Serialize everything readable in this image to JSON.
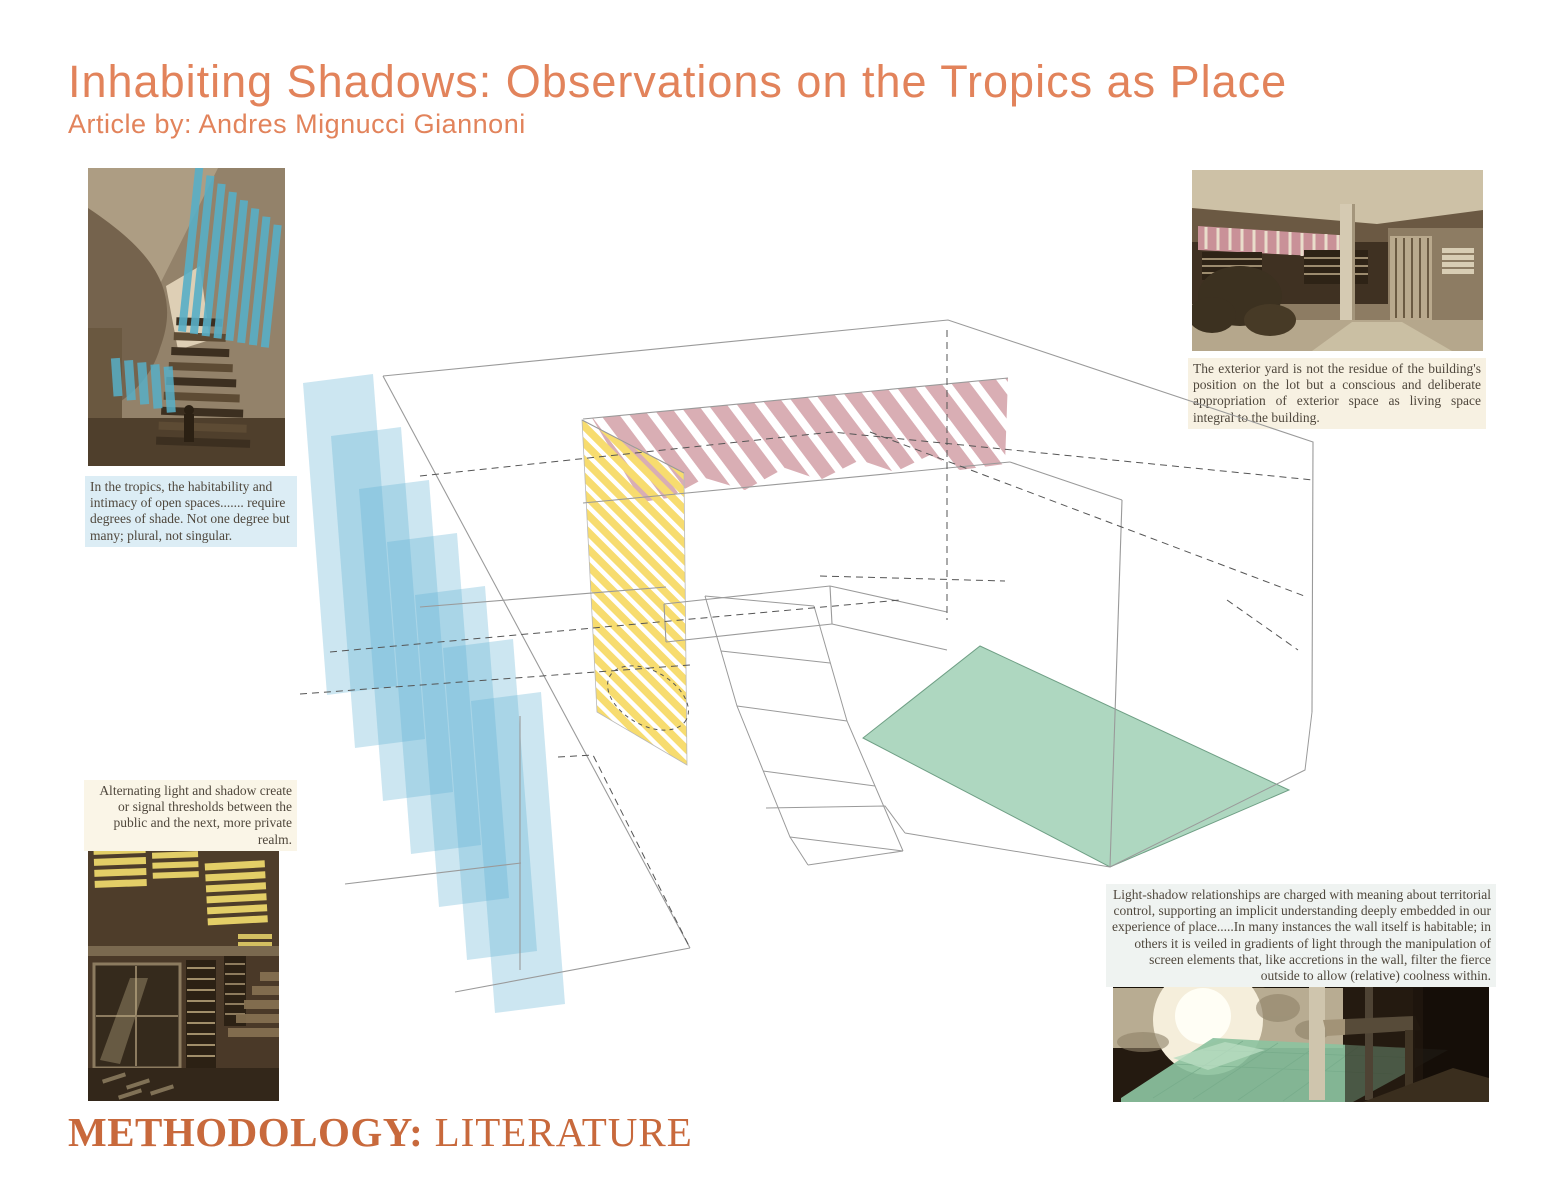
{
  "page": {
    "title": "Inhabiting Shadows: Observations on the Tropics as Place",
    "subtitle": "Article by: Andres Mignucci Giannoni",
    "footer_label": "METHODOLOGY:",
    "footer_value": " LITERATURE"
  },
  "captions": {
    "top_left": "In the tropics, the habitability and intimacy of open spaces.......  require degrees of shade. Not one degree but many; plural, not singular.",
    "bottom_left": "Alternating light and shadow create or signal thresholds between the public and the next, more private realm.",
    "top_right": "The exterior yard is not the residue of the building's position on the lot but a conscious and deliberate appropriation of exterior space as living space integral to the building.",
    "bottom_right": "Light-shadow relationships are charged with meaning about territorial control, supporting an implicit understanding deeply embedded in our experience of place.....In many instances the wall itself is habitable; in others it is veiled in gradients of light through the manipulation of screen elements that, like accretions in the wall, filter the fierce outside to allow (relative) coolness within."
  },
  "colors": {
    "accent": "#E2835B",
    "footer-orange": "#C8693C",
    "caption-ink": "#4f473c",
    "cap-blue-bg": "#dcedf5",
    "cap-cream-bg": "#faf5e7",
    "cap-cream2-bg": "#f7f1e2",
    "cap-grey-bg": "#eff3f1",
    "blue-panel": "#5fb0d4",
    "yellow-stripe": "#f7dc6f",
    "pink-stripe": "#d9aeb4",
    "green-floor": "#aed7c0",
    "teal-highlight": "#58afc7",
    "line-grey": "#9a9a9a",
    "dash-grey": "#555555"
  }
}
